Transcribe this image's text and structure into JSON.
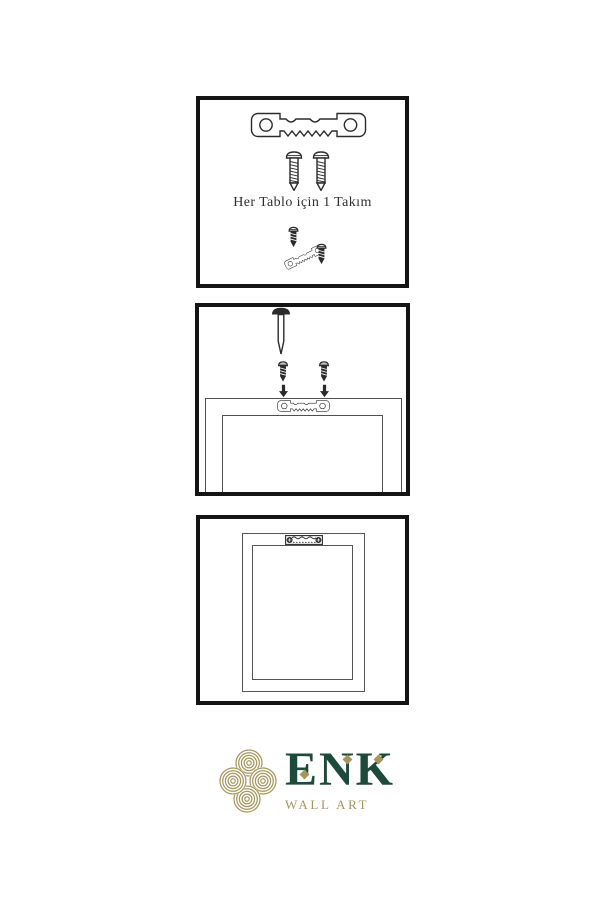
{
  "colors": {
    "background": "#ffffff",
    "ink": "#2b2b2b",
    "border": "#141414",
    "line": "#4f4f4f",
    "green": "#1d4a3a",
    "gold": "#a6955e"
  },
  "panels": {
    "kit": {
      "caption": "Her Tablo için 1 Takım",
      "icons": [
        "sawtooth-hanger-icon",
        "screw-icon",
        "screw-icon",
        "tilted-hanger-with-screws-icon"
      ]
    },
    "install": {
      "icons": [
        "nail-icon",
        "screw-icon",
        "screw-icon",
        "arrow-down-icon",
        "arrow-down-icon",
        "sawtooth-hanger-icon",
        "frame-back-icon"
      ]
    },
    "mounted": {
      "icons": [
        "frame-back-icon",
        "installed-sawtooth-hanger-icon"
      ]
    }
  },
  "logo": {
    "brand": "ENK",
    "subtitle": "WALL ART",
    "icon": "knot-logo-icon"
  }
}
